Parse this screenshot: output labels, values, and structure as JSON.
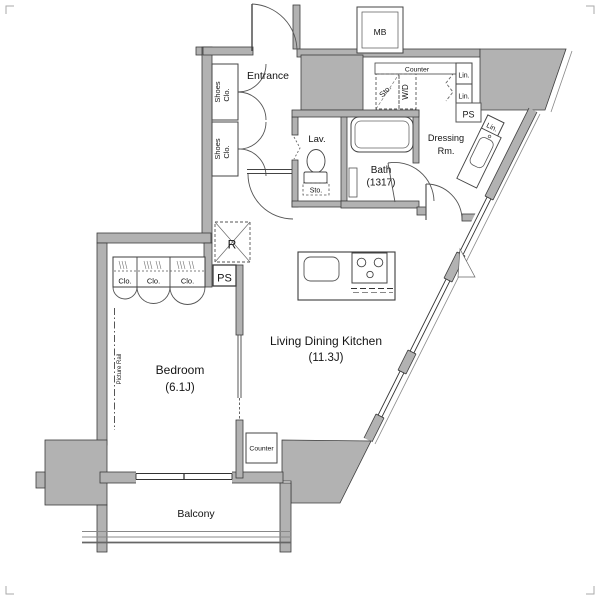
{
  "colors": {
    "wall_fill": "#b2b2b2",
    "wall_edge": "#3c3c3c",
    "line": "#555555",
    "floor": "#ffffff"
  },
  "rooms": {
    "entrance": "Entrance",
    "bedroom": "Bedroom",
    "bedroom_size": "(6.1J)",
    "ldk": "Living Dining Kitchen",
    "ldk_size": "(11.3J)",
    "bath": "Bath",
    "bath_size": "(1317)",
    "lav": "Lav.",
    "dressing_line1": "Dressing",
    "dressing_line2": "Rm.",
    "balcony": "Balcony"
  },
  "fixtures": {
    "mb": "MB",
    "shoes_line1": "Shoes",
    "shoes_line2": "Clo.",
    "counter": "Counter",
    "sto": "Sto.",
    "wd": "W/D",
    "lin": "Lin.",
    "ps": "PS",
    "fridge": "R",
    "clo": "Clo.",
    "picture_rail": "Picture Rail"
  }
}
